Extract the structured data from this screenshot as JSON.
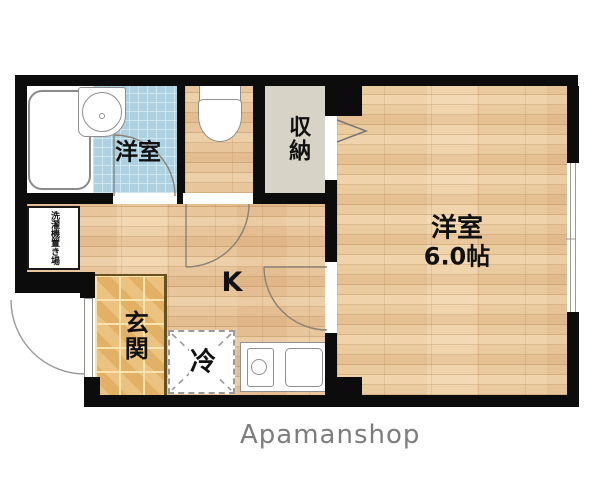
{
  "brand": "Apamanshop",
  "rooms": {
    "bath": {
      "label": "洋室"
    },
    "main": {
      "name": "洋室",
      "size": "6.0帖"
    },
    "closet": {
      "label": "収納"
    },
    "kitchen": {
      "label": "K"
    },
    "entrance": {
      "label": "玄関"
    },
    "laundry": {
      "label": "洗濯機置き場"
    },
    "refrigerator": {
      "label": "冷"
    }
  },
  "colors": {
    "wall": "#0c0c0c",
    "wood_floor": "#e8c59b",
    "entrance_tile": "#e9ba6e",
    "bath_tile": "#aed1e1",
    "closet_fill": "#d7d3c6",
    "brand_text": "#7d7d7d",
    "fixture_outline": "#8a8a8a",
    "door_arc": "#8b8174"
  }
}
